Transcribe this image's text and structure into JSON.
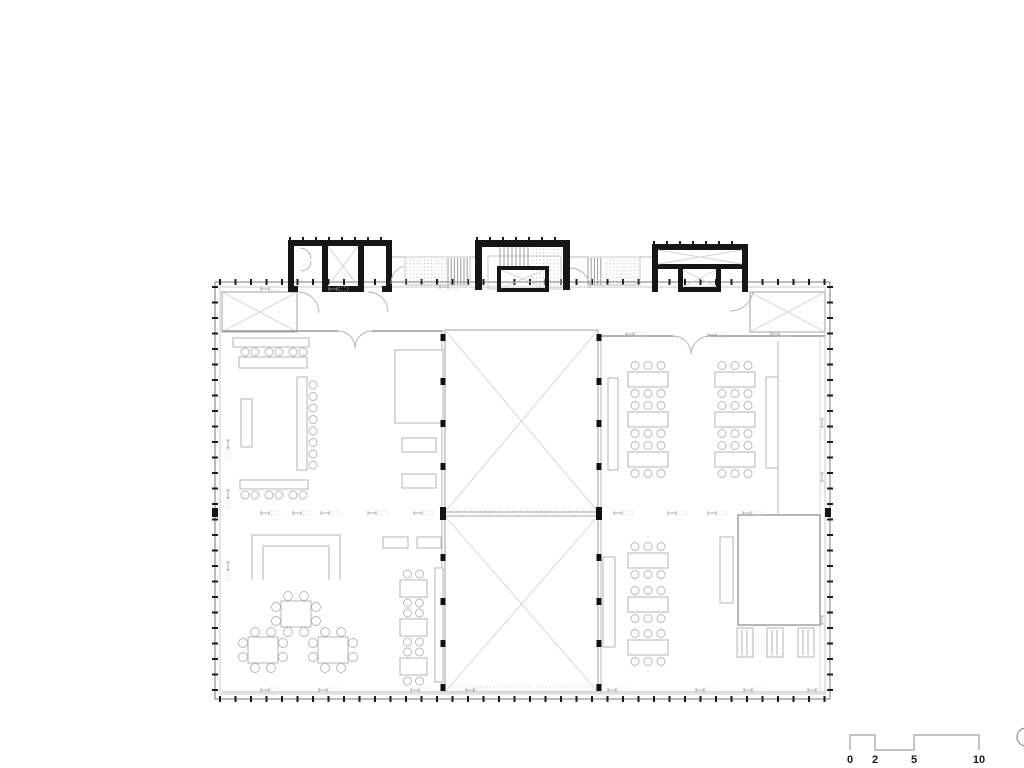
{
  "scale_bar": {
    "path": "M850,750 V735 H875 V750 H914 V735 H979 V750",
    "labels": [
      {
        "t": "0",
        "x": 850
      },
      {
        "t": "2",
        "x": 875
      },
      {
        "t": "5",
        "x": 914
      },
      {
        "t": "10",
        "x": 979
      }
    ],
    "label_y": 763
  },
  "north_marker": {
    "cx": 1026,
    "cy": 737,
    "r": 9
  },
  "colors": {
    "wall": "#161616",
    "facade": "#8f8f8f",
    "light_line": "#c9c9c9",
    "furniture": "#b5b5b5",
    "void_x": "#d2d2d2",
    "tick": "#1a1a1a",
    "background": "#ffffff"
  },
  "plan": {
    "facade": {
      "outer": [
        215,
        282,
        615,
        417
      ],
      "inner": [
        220,
        287,
        605,
        407
      ],
      "tick_spacing": 15.5
    },
    "core_tick_rows": [
      [
        290,
        390,
        240
      ],
      [
        477,
        566,
        240
      ],
      [
        654,
        744,
        244
      ]
    ],
    "walls_black": [
      [
        288,
        240,
        104,
        6
      ],
      [
        288,
        240,
        6,
        52
      ],
      [
        386,
        240,
        6,
        52
      ],
      [
        322,
        246,
        6,
        40
      ],
      [
        358,
        246,
        6,
        40
      ],
      [
        288,
        286,
        10,
        6
      ],
      [
        322,
        286,
        42,
        6
      ],
      [
        382,
        286,
        10,
        6
      ],
      [
        475,
        240,
        95,
        7
      ],
      [
        475,
        240,
        7,
        50
      ],
      [
        563,
        240,
        7,
        50
      ],
      [
        497,
        266,
        52,
        4
      ],
      [
        497,
        266,
        4,
        26
      ],
      [
        545,
        266,
        4,
        26
      ],
      [
        497,
        288,
        52,
        4
      ],
      [
        652,
        244,
        96,
        6
      ],
      [
        652,
        244,
        6,
        48
      ],
      [
        742,
        244,
        6,
        48
      ],
      [
        658,
        264,
        84,
        5
      ],
      [
        678,
        269,
        5,
        23
      ],
      [
        716,
        269,
        5,
        23
      ],
      [
        678,
        287,
        43,
        5
      ],
      [
        212,
        508,
        6,
        9
      ],
      [
        825,
        508,
        6,
        9
      ]
    ],
    "stair_stripes": [
      {
        "x1": 448,
        "x2": 470,
        "y1": 258,
        "y2": 285,
        "step": 3.2
      },
      {
        "x1": 588,
        "x2": 604,
        "y1": 258,
        "y2": 285,
        "step": 3.2
      },
      {
        "x1": 500,
        "x2": 528,
        "y1": 247,
        "y2": 268,
        "step": 4
      }
    ],
    "dotted_areas": [
      [
        405,
        258,
        43,
        27
      ],
      [
        604,
        258,
        36,
        27
      ],
      [
        530,
        248,
        32,
        40
      ]
    ],
    "stair_outlines": [
      [
        405,
        257,
        65,
        28
      ],
      [
        588,
        257,
        52,
        28
      ],
      [
        488,
        256,
        73,
        33
      ]
    ],
    "voids": [
      [
        222,
        292,
        75,
        40
      ],
      [
        750,
        292,
        75,
        40
      ],
      [
        445,
        330,
        153,
        182
      ],
      [
        445,
        516,
        153,
        176
      ]
    ],
    "x_diagonals": [
      [
        328,
        246,
        30,
        40
      ],
      [
        501,
        270,
        44,
        18
      ],
      [
        683,
        270,
        33,
        17
      ],
      [
        658,
        250,
        84,
        14
      ]
    ],
    "room_rects": [
      [
        738,
        515,
        82,
        110
      ]
    ],
    "lines": [
      [
        "wl",
        222,
        331,
        338,
        331
      ],
      [
        "wl",
        372,
        331,
        443,
        331
      ],
      [
        "wl",
        598,
        336,
        673,
        336
      ],
      [
        "wl",
        710,
        336,
        825,
        336
      ],
      [
        "lt",
        442,
        331,
        442,
        692
      ],
      [
        "lt",
        601,
        336,
        601,
        692
      ],
      [
        "lt",
        392,
        257,
        475,
        257
      ],
      [
        "lt",
        570,
        257,
        652,
        257
      ],
      [
        "lt",
        222,
        692,
        825,
        692
      ],
      [
        "lt",
        778,
        341,
        778,
        515
      ],
      [
        "lt2",
        820,
        336,
        820,
        692
      ]
    ],
    "dash_bands": [
      {
        "x1": 450,
        "x2": 594,
        "y": 510,
        "h": 6,
        "step": 7
      },
      {
        "x1": 452,
        "x2": 594,
        "y": 686,
        "h": 5,
        "step": 7
      }
    ],
    "door_arcs": [
      "M338,331 A17 17 0 0 1 355,348",
      "M372,331 A17 17 0 0 0 355,348",
      "M673,336 A18 18 0 0 1 691,354",
      "M710,336 A19 19 0 0 0 691,354",
      "M298,292 A21 21 0 0 1 319,313",
      "M368,292 A20 20 0 0 1 388,312",
      "M570,268 A20 20 0 0 1 590,288",
      "M753,292 A23 23 0 0 1 730,311",
      "M404,266 A18 18 0 0 0 391,284",
      "M300,248 A11 11 0 0 1 311,259",
      "M311,261 A10 10 0 0 1 301,271"
    ],
    "furniture": {
      "rects": [
        [
          233,
          338,
          76,
          9
        ],
        [
          239,
          357,
          68,
          11
        ],
        [
          297,
          377,
          10,
          93
        ],
        [
          241,
          399,
          11,
          48
        ],
        [
          395,
          350,
          48,
          73
        ],
        [
          402,
          438,
          34,
          14
        ],
        [
          402,
          474,
          34,
          14
        ],
        [
          240,
          480,
          68,
          9
        ],
        [
          383,
          537,
          25,
          11
        ],
        [
          417,
          537,
          24,
          11
        ],
        [
          435,
          568,
          8,
          114
        ],
        [
          603,
          557,
          12,
          90
        ],
        [
          720,
          537,
          13,
          66
        ],
        [
          766,
          377,
          12,
          91
        ],
        [
          608,
          378,
          10,
          92
        ]
      ],
      "u_shape": "M252,580 L252,535 L340,535 L340,580 M263,580 L263,546 L329,546 L329,580",
      "six_tables": [
        [
          628,
          372
        ],
        [
          715,
          372
        ],
        [
          628,
          412
        ],
        [
          715,
          412
        ],
        [
          628,
          452
        ],
        [
          715,
          452
        ],
        [
          628,
          553
        ],
        [
          628,
          597
        ],
        [
          628,
          640
        ]
      ],
      "six_size": [
        40,
        15
      ],
      "six_chair_dx": [
        7,
        20,
        33
      ],
      "four_tables": [
        [
          400,
          580
        ],
        [
          400,
          619
        ],
        [
          400,
          658
        ]
      ],
      "four_size": [
        27,
        17
      ],
      "four_chair_dx": [
        7.5,
        19.5
      ],
      "eight_tables": [
        [
          296,
          614
        ],
        [
          263,
          650
        ],
        [
          333,
          650
        ]
      ],
      "eight_offsets": [
        [
          -8,
          -18
        ],
        [
          8,
          -18
        ],
        [
          -8,
          18
        ],
        [
          8,
          18
        ],
        [
          -20,
          -7
        ],
        [
          -20,
          7
        ],
        [
          20,
          -7
        ],
        [
          20,
          7
        ]
      ],
      "stool_rows": [
        {
          "y": 352,
          "xs": [
            245,
            255,
            269,
            279,
            293,
            303
          ]
        },
        {
          "y": 495,
          "xs": [
            245,
            255,
            269,
            279,
            293,
            303
          ]
        }
      ],
      "stool_col": {
        "x": 313,
        "ys": [
          385,
          396.5,
          408,
          419.5,
          431,
          442.5,
          454,
          465
        ]
      },
      "hatched_boxes": [
        [
          737,
          628,
          16,
          29
        ],
        [
          767,
          628,
          16,
          29
        ],
        [
          798,
          628,
          16,
          29
        ]
      ]
    },
    "column_marks": {
      "xs": [
        440.5,
        596.5
      ],
      "ys": [
        337,
        381,
        423,
        466,
        557,
        601,
        643,
        687
      ],
      "big_y": 507
    },
    "fittings": {
      "horizontal": [
        [
          265,
          289
        ],
        [
          333,
          289
        ],
        [
          444,
          287
        ],
        [
          630,
          334
        ],
        [
          712,
          335
        ],
        [
          775,
          334
        ],
        [
          265,
          513
        ],
        [
          297,
          513
        ],
        [
          325,
          513
        ],
        [
          372,
          513
        ],
        [
          418,
          513
        ],
        [
          618,
          513
        ],
        [
          672,
          513
        ],
        [
          712,
          513
        ],
        [
          747,
          513
        ],
        [
          265,
          690
        ],
        [
          323,
          690
        ],
        [
          415,
          690
        ],
        [
          470,
          690
        ],
        [
          612,
          690
        ],
        [
          700,
          690
        ],
        [
          748,
          690
        ],
        [
          812,
          690
        ]
      ],
      "vertical": [
        [
          228,
          444
        ],
        [
          228,
          494
        ],
        [
          228,
          566
        ],
        [
          822,
          423
        ],
        [
          822,
          477
        ],
        [
          822,
          620
        ]
      ]
    }
  }
}
